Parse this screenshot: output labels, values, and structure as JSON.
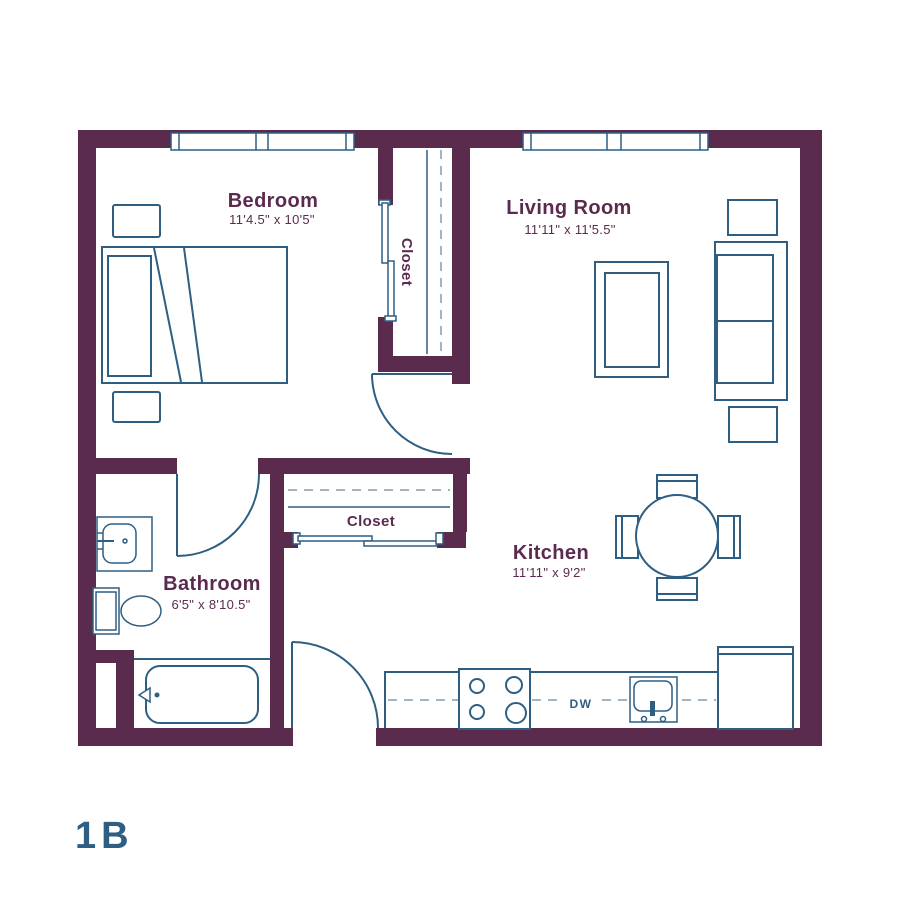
{
  "unit_label": "1B",
  "rooms": {
    "bedroom": {
      "name": "Bedroom",
      "dims": "11'4.5\" x 10'5\""
    },
    "living_room": {
      "name": "Living Room",
      "dims": "11'11\" x 11'5.5\""
    },
    "kitchen": {
      "name": "Kitchen",
      "dims": "11'11\" x 9'2\""
    },
    "bathroom": {
      "name": "Bathroom",
      "dims": "6'5\" x 8'10.5\""
    }
  },
  "closets": {
    "bedroom_closet_label": "Closet",
    "hall_closet_label": "Closet"
  },
  "appliances": {
    "dishwasher_label": "DW"
  },
  "colors": {
    "wall": "#5b2b4e",
    "line": "#2e5f82",
    "dash": "#93aabb",
    "background": "#ffffff"
  }
}
